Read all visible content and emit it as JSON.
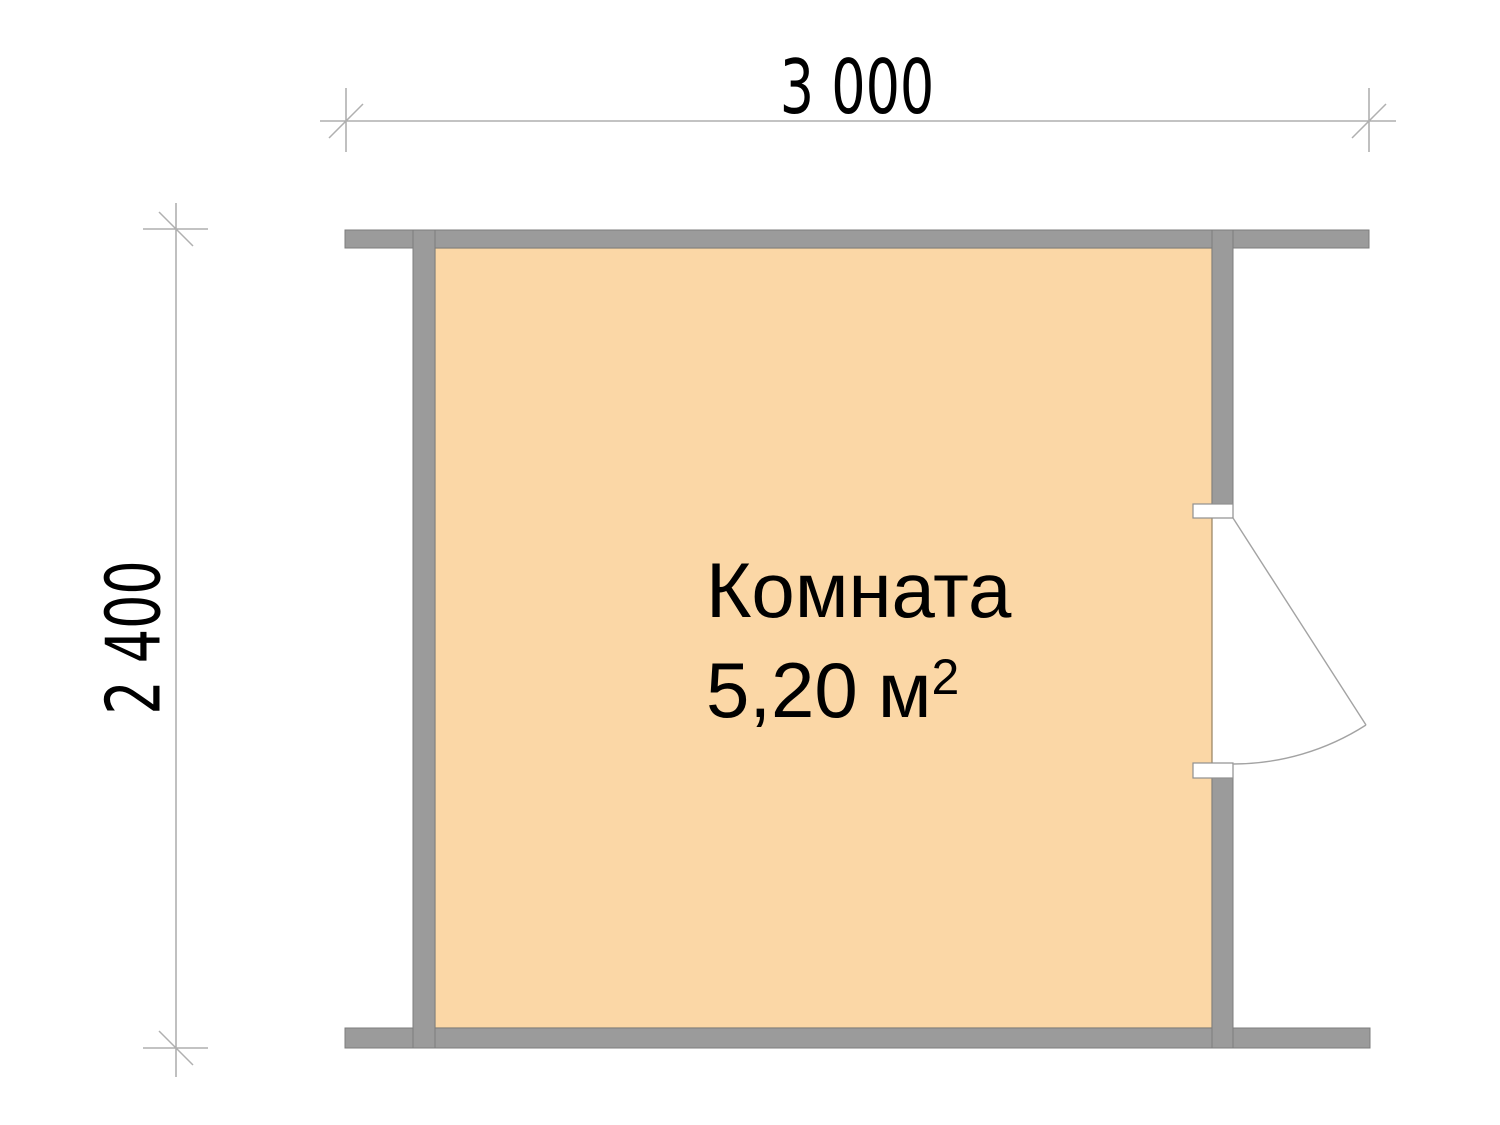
{
  "room": {
    "name": "Комната",
    "area_value": "5,20",
    "area_unit": "м",
    "area_superscript": "2"
  },
  "dimensions": {
    "width_label": "3 000",
    "height_label": "2 400"
  },
  "colors": {
    "background": "#ffffff",
    "wall_gray": "#9b9b9b",
    "wall_outline": "#7d7d7d",
    "room_fill": "#fbd7a6",
    "room_outline": "#96805f",
    "dimension_line_gray": "#9f9f9f",
    "door_line_gray": "#a3a3a3",
    "text_black": "#000000"
  }
}
